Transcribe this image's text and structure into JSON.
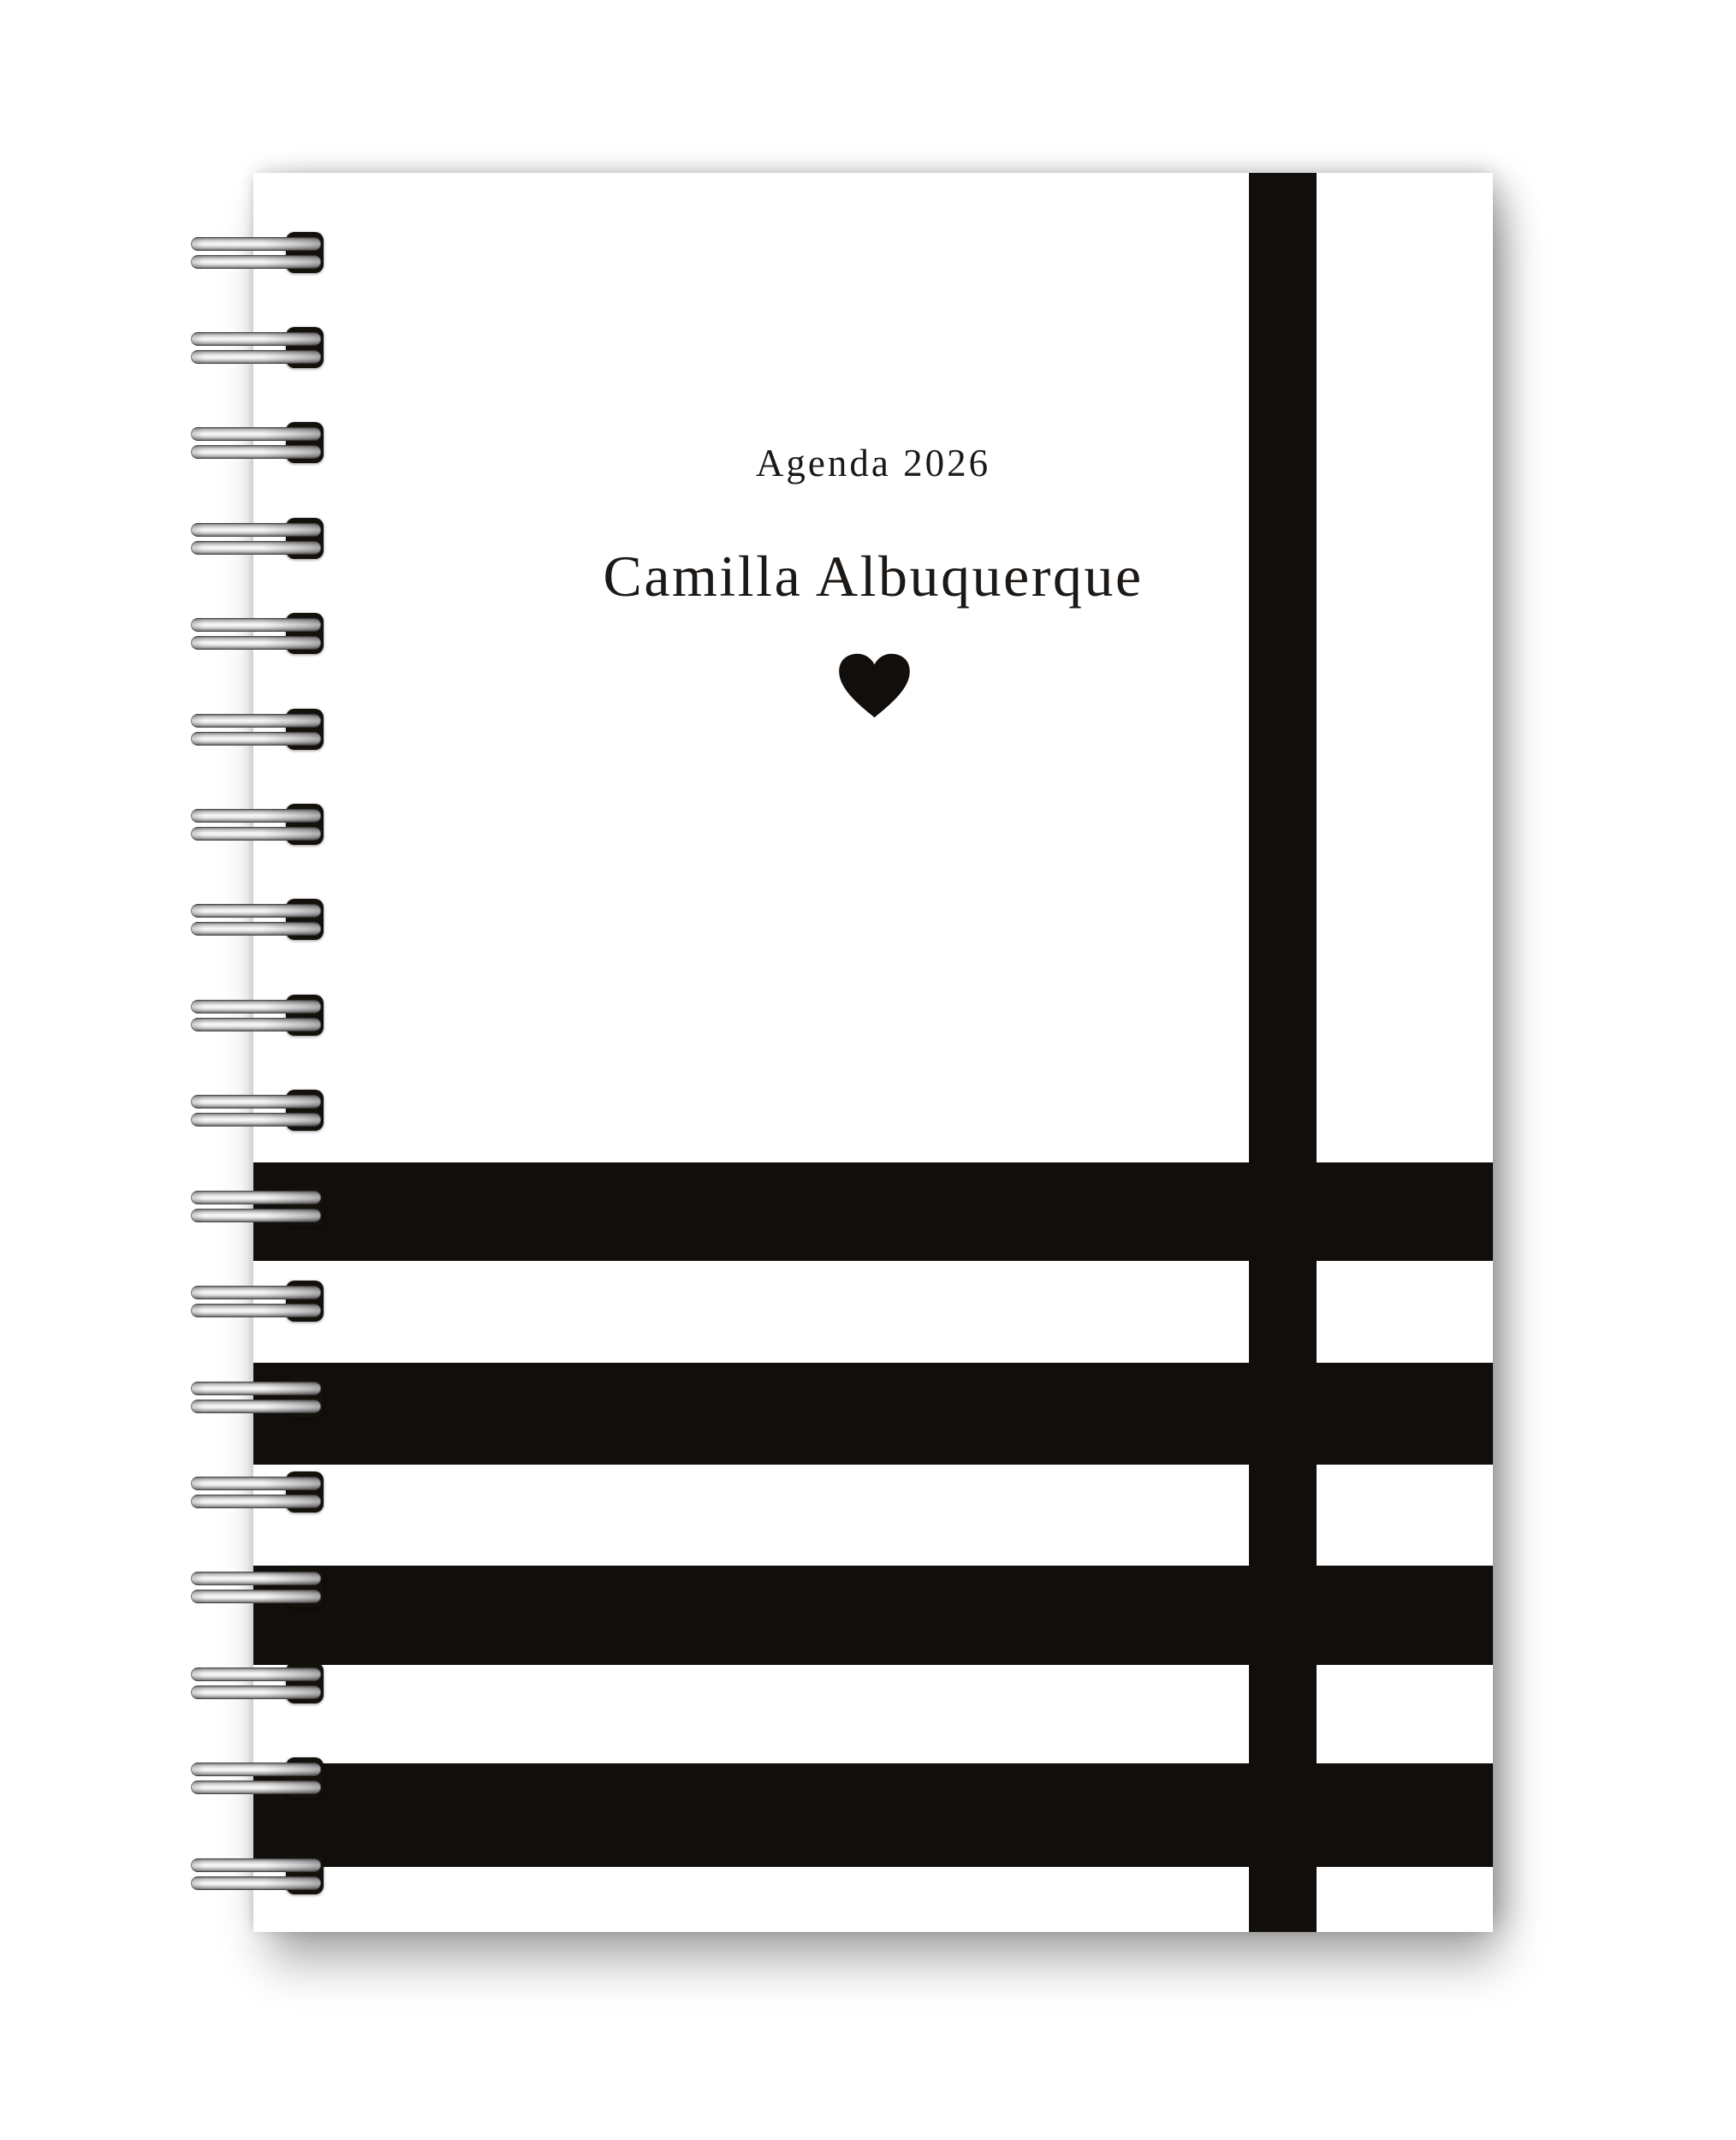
{
  "notebook": {
    "subtitle": "Agenda 2026",
    "title": "Camilla Albuquerque",
    "heart_icon": "heart-icon"
  },
  "design": {
    "accent_black": "#120e0b",
    "cover_white": "#ffffff",
    "text_color": "#1c1815",
    "coil_count": 18,
    "horizontal_stripe_count": 4,
    "vertical_stripe_count": 1
  }
}
